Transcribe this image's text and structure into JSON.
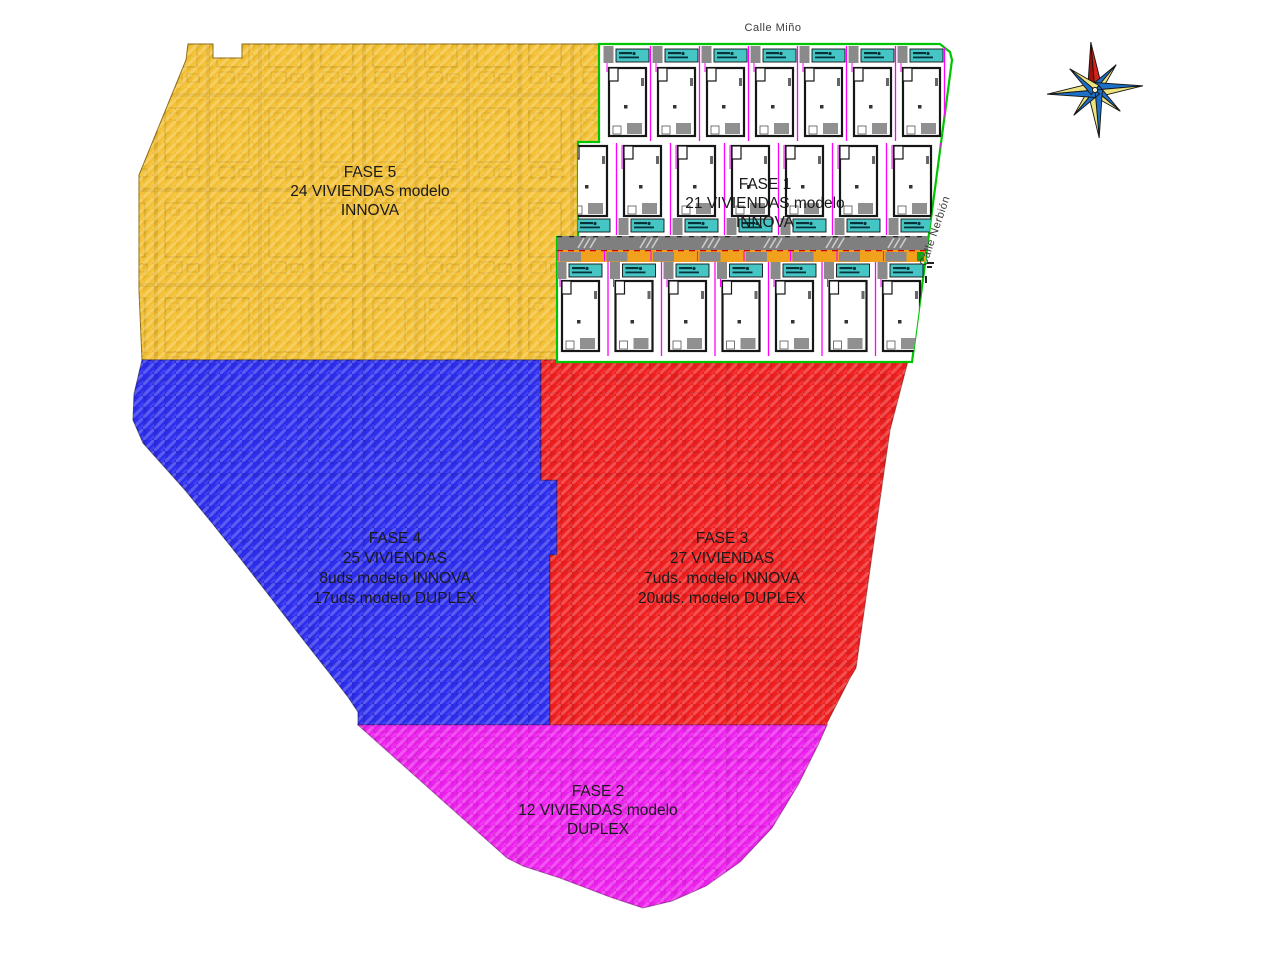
{
  "plan": {
    "regions": {
      "fase5": {
        "lines": [
          "FASE 5",
          "24 VIVIENDAS modelo",
          "INNOVA"
        ]
      },
      "fase1": {
        "lines": [
          "FASE 1",
          "21 VIVIENDAS modelo",
          "INNOVA"
        ],
        "rows": [
          {
            "units": 7
          },
          {
            "units": 7
          },
          {
            "units": 7
          }
        ]
      },
      "fase4": {
        "lines": [
          "FASE 4",
          "25 VIVIENDAS",
          "8uds.modelo INNOVA",
          "17uds.modelo DUPLEX"
        ]
      },
      "fase3": {
        "lines": [
          "FASE 3",
          "27 VIVIENDAS",
          "7uds. modelo INNOVA",
          "20uds. modelo DUPLEX"
        ]
      },
      "fase2": {
        "lines": [
          "FASE 2",
          "12 VIVIENDAS modelo",
          "DUPLEX"
        ]
      }
    },
    "streets": {
      "top": "Calle Miño",
      "right": "Calle Nerbión"
    },
    "colors": {
      "fase5_yellow": "#F4C136",
      "fase4_blue": "#2E2EEF",
      "fase3_red": "#F02020",
      "fase2_magenta": "#EE22EE",
      "fase1_white": "#FFFFFF",
      "boundary_green": "#00C400",
      "road_gray": "#7F7F7F",
      "parking_orange": "#F2A11C",
      "plot_line_magenta": "#FF00FF",
      "plate_cyan": "#46C5C5",
      "compass_red": "#D42418",
      "compass_blue": "#1D70C8",
      "compass_yellow": "#EDE27D"
    }
  }
}
